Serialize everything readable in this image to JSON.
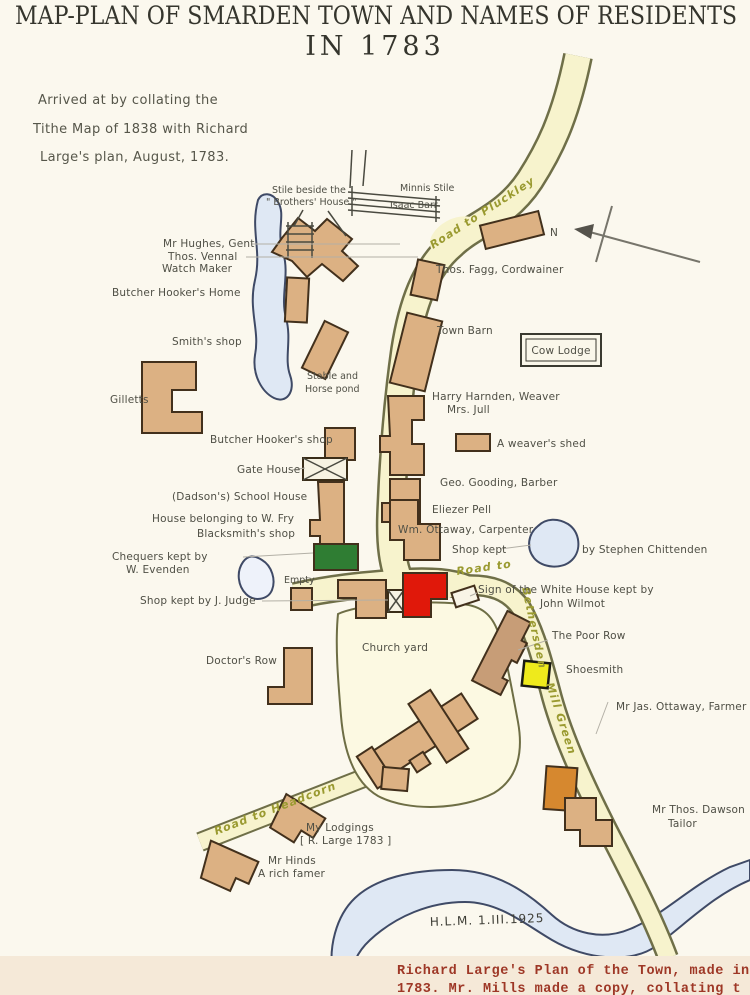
{
  "header": {
    "title_line1": "MAP-PLAN OF SMARDEN TOWN AND NAMES OF RESIDENTS",
    "title_line2": "IN 1783",
    "note_line1": "Arrived at by collating the",
    "note_line2": "Tithe Map of 1838 with Richard",
    "note_line3": "Large's plan, August, 1783."
  },
  "compass": {
    "north": "N"
  },
  "roads": {
    "pluckley": "Road to Pluckley",
    "bethersden_part1": "Road to",
    "bethersden_part2": "Bethersden",
    "mill_green": "Mill Green",
    "headcorn": "Road to Headcorn"
  },
  "legend_box": {
    "cow_lodge": "Cow Lodge"
  },
  "labels": {
    "stile_line1": "Stile beside the",
    "stile_line2": "\" Brothers' House \"",
    "minnis_stile": "Minnis Stile",
    "isaac_barr": "Isaac Barr",
    "hughes": "Mr Hughes, Gent",
    "vennal_line1": "Thos. Vennal",
    "vennal_line2": "Watch Maker",
    "fagg": "Thos. Fagg, Cordwainer",
    "hooker_home": "Butcher Hooker's Home",
    "town_barn": "Town Barn",
    "smiths_shop": "Smith's shop",
    "stable_line1": "Stable and",
    "stable_line2": "Horse pond",
    "gilletts": "Gilletts",
    "harnden": "Harry Harnden, Weaver",
    "jull": "Mrs. Jull",
    "weavers_shed": "A weaver's shed",
    "hooker_shop": "Butcher Hooker's shop",
    "gooding": "Geo. Gooding, Barber",
    "gate_house": "Gate House",
    "school_house": "(Dadson's) School House",
    "fry_house": "House belonging to W. Fry",
    "blacksmith": "Blacksmith's shop",
    "pell": "Eliezer Pell",
    "ottaway_carpenter": "Wm. Ottaway, Carpenter",
    "shop_kept": "Shop kept",
    "chittenden": "by Stephen Chittenden",
    "chequers_line1": "Chequers kept by",
    "chequers_line2": "W. Evenden",
    "empty": "Empty",
    "judge": "Shop kept by J. Judge",
    "white_house_line1": "Sign of the White House kept by",
    "white_house_line2": "John Wilmot",
    "poor_row": "The Poor Row",
    "shoesmith": "Shoesmith",
    "church_yard": "Church yard",
    "ottaway_farmer": "Mr Jas. Ottaway, Farmer",
    "doctors_row": "Doctor's Row",
    "lodgings_line1": "My Lodgings",
    "lodgings_line2": "[ R. Large 1783 ]",
    "hinds_line1": "Mr Hinds",
    "hinds_line2": "A rich famer",
    "dawson_line1": "Mr Thos. Dawson",
    "dawson_line2": "Tailor"
  },
  "signature": "H.L.M. 1.III.1925",
  "footer": {
    "line1": "Richard Large's Plan of the Town, made in",
    "line2": "1783.  Mr. Mills made a copy, collating t"
  },
  "colors": {
    "road_fill": "#f7f3cd",
    "building": "#dcb183",
    "poor_row_building": "#c79d77",
    "red_building": "#e0180a",
    "green_building": "#2f7d33",
    "yellow_building": "#eeea1c",
    "orange_building": "#d6882f",
    "water": "#dfe8f4",
    "road_label_ink": "#9a9a30",
    "typed_text": "#9e3726"
  }
}
